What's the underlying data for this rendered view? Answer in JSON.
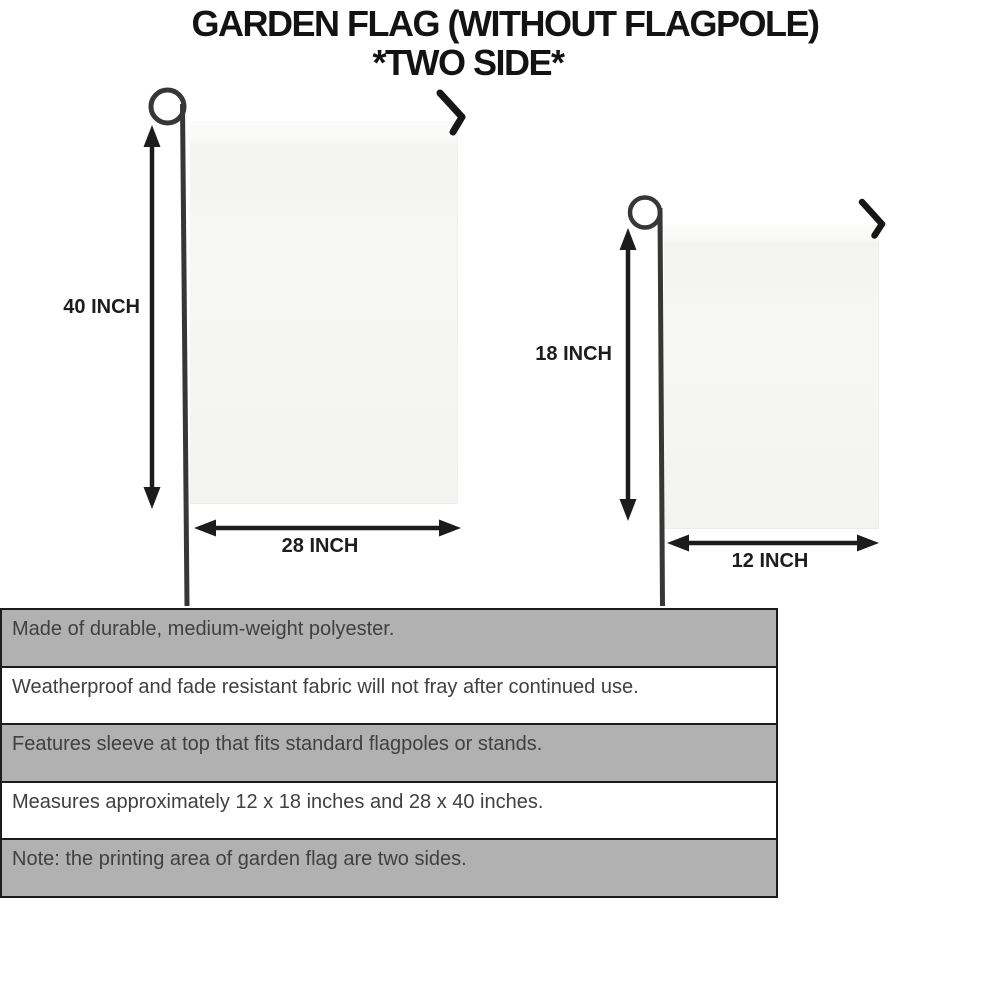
{
  "title": {
    "line1": "GARDEN FLAG (WITHOUT FLAGPOLE)",
    "line2": "*TWO SIDE*"
  },
  "diagram": {
    "large_flag": {
      "height_label": "40 INCH",
      "width_label": "28 INCH"
    },
    "small_flag": {
      "height_label": "18 INCH",
      "width_label": "12 INCH"
    }
  },
  "features": {
    "rows": [
      {
        "text": "Made of durable, medium-weight polyester."
      },
      {
        "text": "Weatherproof and fade resistant fabric will not fray after continued use."
      },
      {
        "text": "Features sleeve at top that fits standard flagpoles or stands."
      },
      {
        "text": "Measures approximately 12 x 18 inches and 28 x 40 inches."
      },
      {
        "text": "Note: the printing area of garden flag are two sides."
      }
    ]
  },
  "colors": {
    "background": "#ffffff",
    "ink": "#1d1d1d",
    "pole": "#373737",
    "flag_fill": "#f5f5f3",
    "row_shaded": "#b1b1b1",
    "row_plain": "#ffffff",
    "table_border": "#1c1c1c",
    "feature_text": "#404040"
  }
}
